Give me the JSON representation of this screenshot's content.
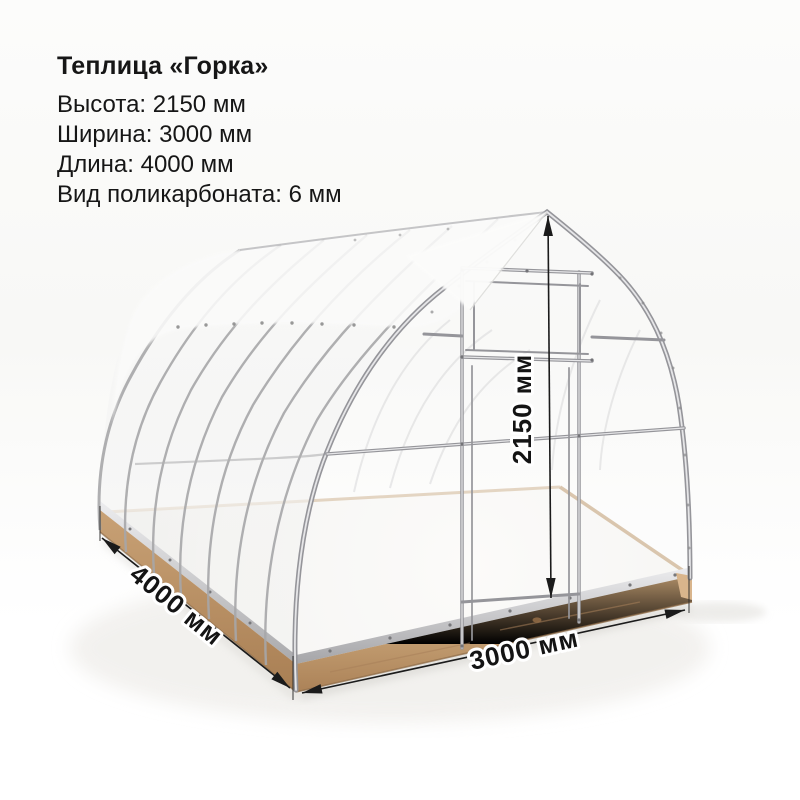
{
  "product": {
    "title": "Теплица «Горка»",
    "specs": [
      "Высота: 2150 мм",
      "Ширина: 3000 мм",
      "Длина: 4000 мм",
      "Вид поликарбоната: 6 мм"
    ]
  },
  "dimensions": {
    "height": "2150 мм",
    "width": "3000 мм",
    "length": "4000 мм"
  },
  "colors": {
    "text": "#161616",
    "dimension_line": "#1b1b1b",
    "frame_metal": "#a3a3a6",
    "wood_base": "#c09a6e",
    "panel_white": "#f7f7f6",
    "background": "#fafaf8"
  }
}
